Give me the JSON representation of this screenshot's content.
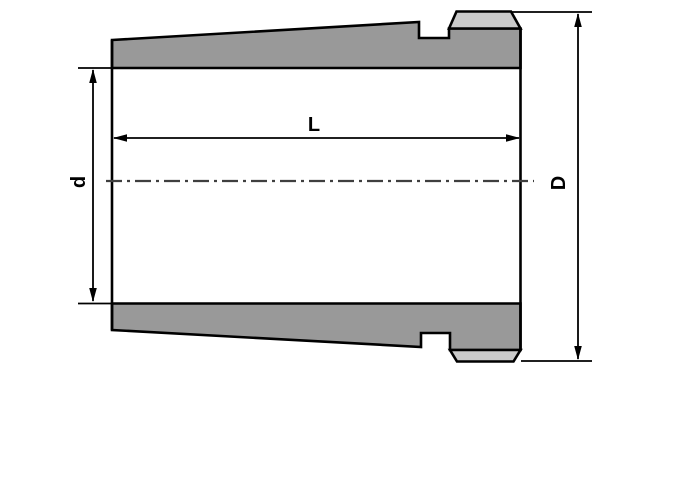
{
  "drawing": {
    "description": "Cross-section technical drawing of a tapered adapter sleeve with external thread at the large end",
    "labels": {
      "length": "L",
      "bore_diameter": "d",
      "outer_diameter": "D"
    },
    "colors": {
      "background": "#ffffff",
      "wall_fill": "#999999",
      "thread_fill": "#cacaca",
      "outline": "#000000",
      "centerline": "#3f3f3f"
    }
  }
}
